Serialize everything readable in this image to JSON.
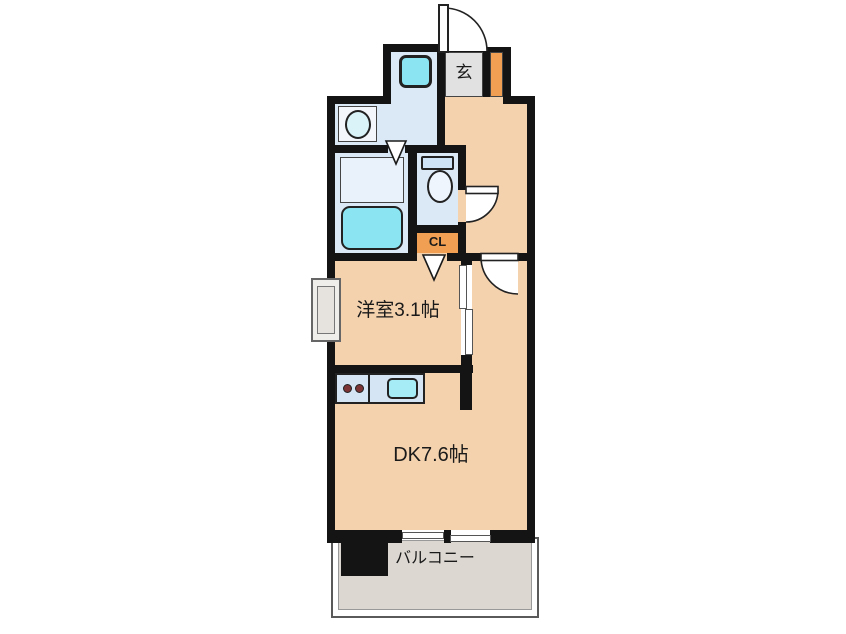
{
  "title": "1DK apartment floor plan",
  "colors": {
    "wall": "#141414",
    "room_tan": "#f4d2ae",
    "wet_blue": "#dbe8f5",
    "fixture_cyan": "#8ae4f2",
    "entry_gray": "#e1e1e1",
    "closet_orange": "#f1a053",
    "balcony_gray": "#dcd7d1"
  },
  "rooms": {
    "entry": {
      "label": "玄"
    },
    "closet": {
      "label": "CL"
    },
    "western_room": {
      "label": "洋室3.1帖"
    },
    "dining_kitchen": {
      "label": "DK7.6帖"
    },
    "balcony": {
      "label": "バルコニー"
    }
  },
  "fixtures": [
    "entrance-door",
    "washing-machine",
    "lavatory-sink",
    "shower-area",
    "bathtub",
    "toilet",
    "toilet-door",
    "closet-door-mark",
    "bathroom-door-mark",
    "sliding-door",
    "dk-door",
    "kitchen-counter",
    "stove-burners",
    "kitchen-sink",
    "meter-box",
    "sliding-window",
    "pillar"
  ]
}
